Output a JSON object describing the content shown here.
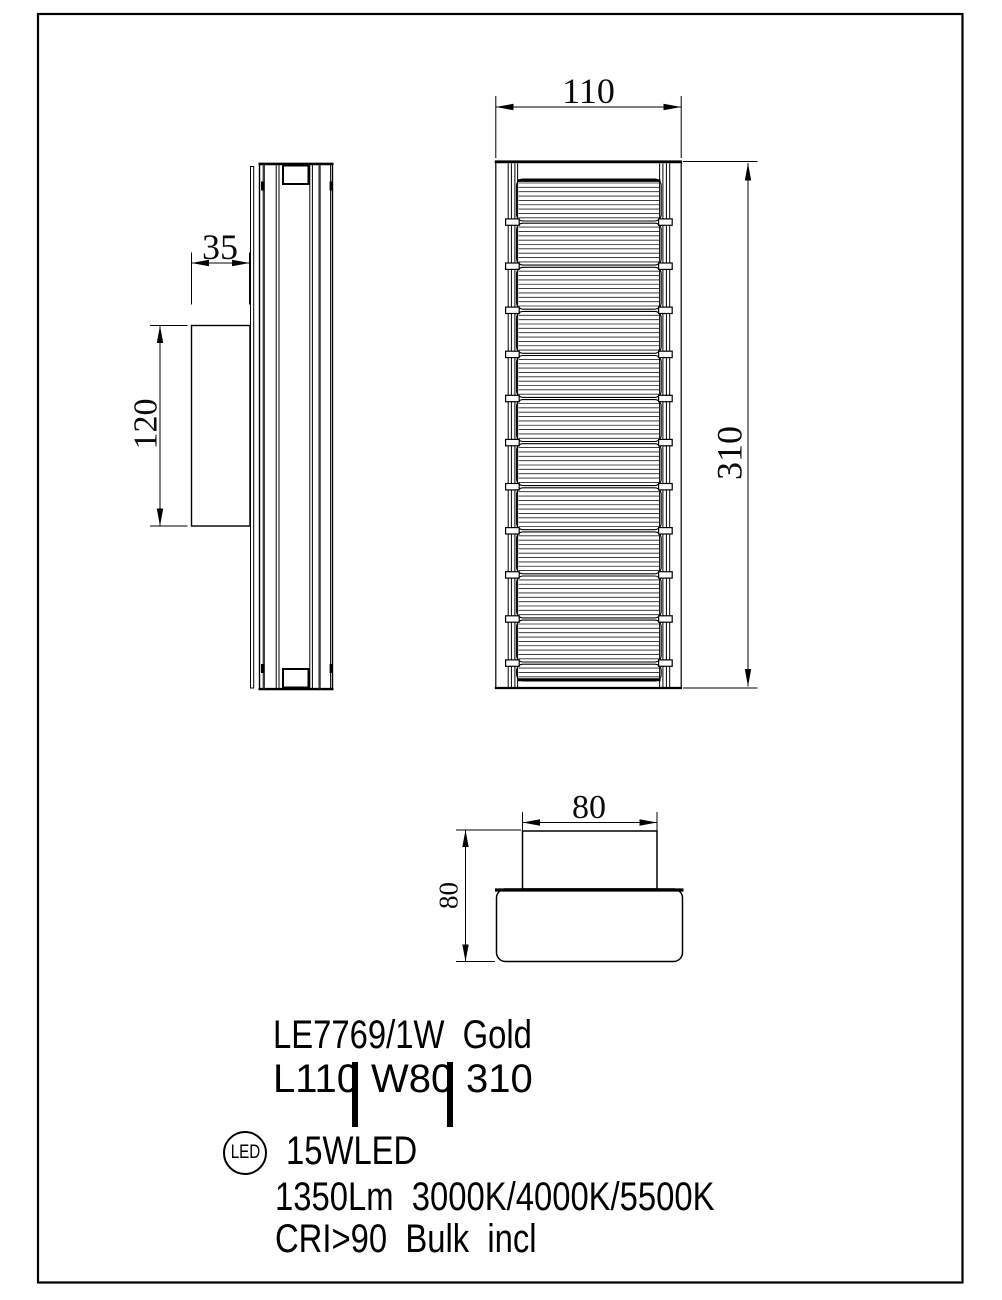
{
  "page": {
    "background": "#ffffff",
    "line_color": "#000000"
  },
  "drawing": {
    "side_view": {
      "bracket_depth": "35",
      "bracket_height": "120"
    },
    "front_view": {
      "width": "110",
      "height": "310"
    },
    "top_view": {
      "bracket_width": "80",
      "depth": "80"
    }
  },
  "spec": {
    "model": "LE7769/1W  Gold",
    "dim_l": "L110",
    "dim_w": "W80",
    "dim_h": "310",
    "led_badge": "LED",
    "power": "15WLED",
    "lumens_cct": "1350Lm  3000K/4000K/5500K",
    "cri": "CRI>90  Bulk  incl"
  }
}
